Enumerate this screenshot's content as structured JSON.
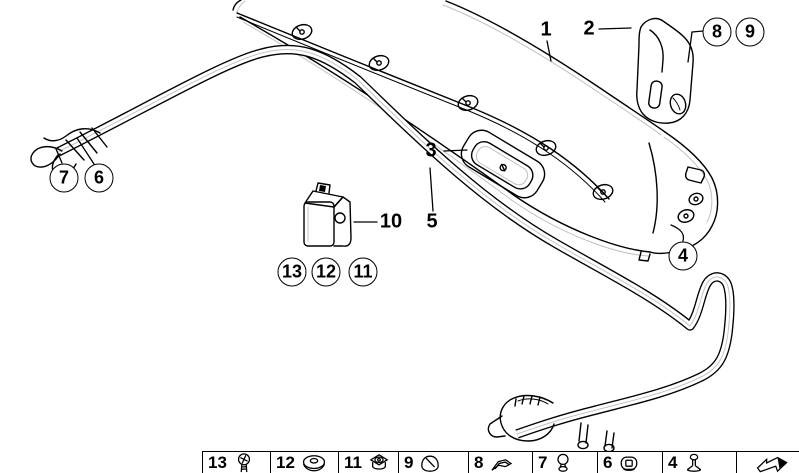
{
  "diagram_title": "trunk-lid-trim-and-seal-parts-diagram",
  "callouts": {
    "label_1": "1",
    "label_2": "2",
    "label_3": "3",
    "label_5": "5",
    "label_10": "10"
  },
  "circles": {
    "circle_7": "7",
    "circle_6": "6",
    "circle_8": "8",
    "circle_9": "9",
    "circle_13": "13",
    "circle_12": "12",
    "circle_11": "11",
    "circle_4": "4"
  },
  "legend": {
    "cells": [
      {
        "number": "13",
        "icon": "screw-icon"
      },
      {
        "number": "12",
        "icon": "washer-icon"
      },
      {
        "number": "11",
        "icon": "flange-nut-icon"
      },
      {
        "number": "9",
        "icon": "clip-cap-icon"
      },
      {
        "number": "8",
        "icon": "sheet-clip-icon"
      },
      {
        "number": "7",
        "icon": "ball-pin-icon"
      },
      {
        "number": "6",
        "icon": "cap-nut-icon"
      },
      {
        "number": "4",
        "icon": "push-rivet-icon"
      },
      {
        "number": "",
        "icon": "direction-arrow-icon"
      }
    ]
  },
  "colors": {
    "line": "#000000",
    "background": "#ffffff",
    "highlight_line": "#c0c0c0"
  }
}
